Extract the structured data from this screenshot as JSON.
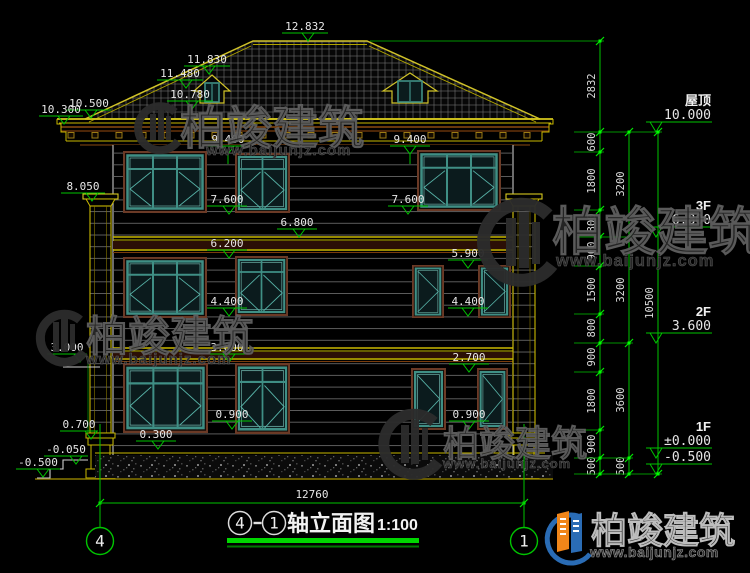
{
  "title": {
    "bubble_left": "4",
    "dash": "-",
    "bubble_right": "1",
    "text": "轴立面图",
    "scale": "1:100"
  },
  "axes": {
    "left": "4",
    "right": "1"
  },
  "bottom_dim": {
    "total": "12760"
  },
  "watermark": {
    "brand": "柏竣建筑",
    "url": "www.baijunjz.com"
  },
  "logo": {
    "brand": "柏竣建筑",
    "url": "www.baijunjz.com"
  },
  "colors": {
    "cad_green": "#00c400",
    "cad_yellow": "#c9b800",
    "teal_frame": "#3f8f85",
    "brown_frame": "#6b3a26",
    "cornice_brown": "#8a4a10",
    "logo_blue": "#2a6cb5",
    "logo_orange": "#f08519"
  },
  "facade_markers": [
    {
      "v": "12.832",
      "lx": 282,
      "ly": 33,
      "w": 46,
      "tx": 308,
      "tail": 0
    },
    {
      "v": "11.830",
      "lx": 184,
      "ly": 66,
      "w": 46,
      "tx": 209,
      "tail": 0
    },
    {
      "v": "11.480",
      "lx": 157,
      "ly": 80,
      "w": 46,
      "tx": 186,
      "tail": 0
    },
    {
      "v": "10.780",
      "lx": 167,
      "ly": 101,
      "w": 46,
      "tx": 192,
      "tail": 0
    },
    {
      "v": "10.500",
      "lx": 67,
      "ly": 110,
      "w": 44,
      "tx": 91,
      "tail": 0
    },
    {
      "v": "10.300",
      "lx": 39,
      "ly": 116,
      "w": 44,
      "tx": 64,
      "tail": 0
    },
    {
      "v": "9.400",
      "lx": 208,
      "ly": 146,
      "w": 40,
      "tx": 228,
      "tail": 10
    },
    {
      "v": "9.400",
      "lx": 390,
      "ly": 146,
      "w": 40,
      "tx": 410,
      "tail": 10
    },
    {
      "v": "8.050",
      "lx": 61,
      "ly": 193,
      "w": 44,
      "tx": 92,
      "tail": 0
    },
    {
      "v": "7.600",
      "lx": 207,
      "ly": 206,
      "w": 40,
      "tx": 229,
      "tail": 0
    },
    {
      "v": "7.600",
      "lx": 388,
      "ly": 206,
      "w": 40,
      "tx": 408,
      "tail": 0
    },
    {
      "v": "6.800",
      "lx": 277,
      "ly": 229,
      "w": 40,
      "tx": 299,
      "tail": 0
    },
    {
      "v": "6.200",
      "lx": 207,
      "ly": 250,
      "w": 40,
      "tx": 229,
      "tail": 0
    },
    {
      "v": "5.900",
      "lx": 448,
      "ly": 260,
      "w": 40,
      "tx": 468,
      "tail": 0
    },
    {
      "v": "4.400",
      "lx": 207,
      "ly": 308,
      "w": 40,
      "tx": 229,
      "tail": 0
    },
    {
      "v": "4.400",
      "lx": 448,
      "ly": 308,
      "w": 40,
      "tx": 468,
      "tail": 0
    },
    {
      "v": "3.000",
      "lx": 47,
      "ly": 354,
      "w": 40,
      "tx": 80,
      "tail": 0
    },
    {
      "v": "3.000",
      "lx": 207,
      "ly": 354,
      "w": 40,
      "tx": 229,
      "tail": 0
    },
    {
      "v": "2.700",
      "lx": 449,
      "ly": 364,
      "w": 40,
      "tx": 469,
      "tail": 0
    },
    {
      "v": "0.900",
      "lx": 212,
      "ly": 421,
      "w": 40,
      "tx": 232,
      "tail": 0
    },
    {
      "v": "0.900",
      "lx": 449,
      "ly": 421,
      "w": 40,
      "tx": 469,
      "tail": 0
    },
    {
      "v": "0.700",
      "lx": 60,
      "ly": 431,
      "w": 38,
      "tx": 91,
      "tail": 0
    },
    {
      "v": "0.300",
      "lx": 136,
      "ly": 441,
      "w": 40,
      "tx": 158,
      "tail": 0
    },
    {
      "v": "-0.050",
      "lx": 44,
      "ly": 456,
      "w": 44,
      "tx": 76,
      "tail": 0
    },
    {
      "v": "-0.500",
      "lx": 16,
      "ly": 469,
      "w": 44,
      "tx": 43,
      "tail": 0
    }
  ],
  "levels_right": [
    {
      "label": "屋顶",
      "value": "10.000",
      "ly": 122
    },
    {
      "label": "3F",
      "value": "6.800",
      "ly": 227
    },
    {
      "label": "2F",
      "value": "3.600",
      "ly": 333
    },
    {
      "label": "1F",
      "value": "±0.000",
      "ly": 448
    },
    {
      "label": "",
      "value": "-0.500",
      "ly": 464
    }
  ],
  "dim_chains": [
    {
      "x": 600,
      "ticks": [
        41,
        132,
        152,
        210,
        237,
        266,
        314,
        343,
        372,
        430,
        458,
        474
      ],
      "labels": [
        [
          "2832",
          86
        ],
        [
          "600",
          142
        ],
        [
          "1800",
          181
        ],
        [
          "800",
          223
        ],
        [
          "900",
          251
        ],
        [
          "1500",
          290
        ],
        [
          "800",
          328
        ],
        [
          "900",
          357
        ],
        [
          "1800",
          401
        ],
        [
          "900",
          444
        ],
        [
          "500",
          466
        ]
      ]
    },
    {
      "x": 629,
      "ticks": [
        132,
        237,
        343,
        458,
        474
      ],
      "labels": [
        [
          "3200",
          184
        ],
        [
          "3200",
          290
        ],
        [
          "3600",
          400
        ],
        [
          "500",
          466
        ]
      ]
    },
    {
      "x": 658,
      "ticks": [
        132,
        474
      ],
      "labels": [
        [
          "10500",
          303
        ]
      ]
    }
  ]
}
